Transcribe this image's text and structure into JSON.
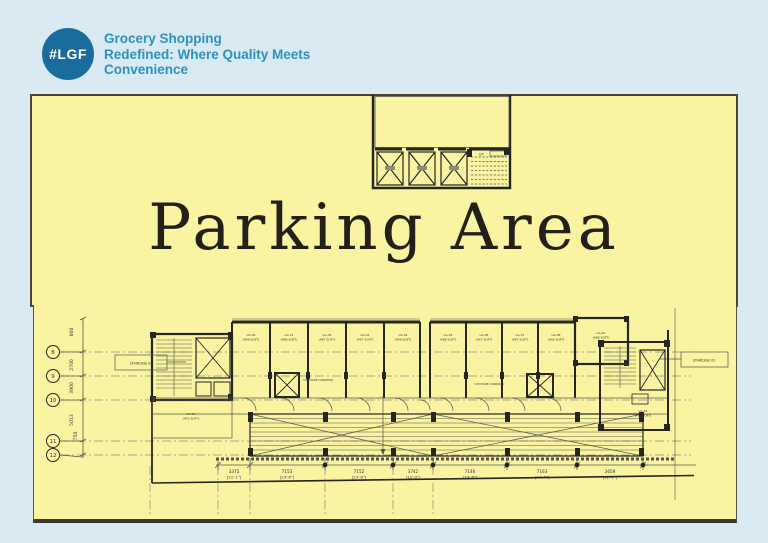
{
  "header": {
    "logo_text": "#LGF",
    "tagline_line1": "Grocery Shopping",
    "tagline_line2": "Redefined: Where Quality Meets",
    "tagline_line3": "Convenience"
  },
  "parking": {
    "title": "Parking Area"
  },
  "upper_core": {
    "up_label": "UP"
  },
  "floor_plan": {
    "grid_bubbles": [
      "8",
      "9",
      "10",
      "11",
      "12"
    ],
    "left_dimensions": [
      "600",
      "2700",
      "3900",
      "5013",
      "750"
    ],
    "bottom_dimensions": [
      {
        "mm": "3375",
        "ft": "[11'-1\"]"
      },
      {
        "mm": "7153",
        "ft": "[23'-6\"]"
      },
      {
        "mm": "7152",
        "ft": "[23'-6\"]"
      },
      {
        "mm": "3742",
        "ft": "[12'-3\"]"
      },
      {
        "mm": "7146",
        "ft": "[23'-6\"]"
      },
      {
        "mm": "7163",
        "ft": "[23'-6\"]"
      },
      {
        "mm": "3659",
        "ft": "[12'-0\"]"
      }
    ],
    "units_bank1": [
      {
        "name": "LG-30",
        "area": "(498 SQFT)"
      },
      {
        "name": "LG-31",
        "area": "(488 SQFT)"
      },
      {
        "name": "LG-32",
        "area": "(487 SQFT)"
      },
      {
        "name": "LG-33",
        "area": "(487 SQFT)"
      },
      {
        "name": "LG-34",
        "area": "(488 SQFT)"
      }
    ],
    "units_bank2": [
      {
        "name": "LG-35",
        "area": "(488 SQFT)"
      },
      {
        "name": "LG-36",
        "area": "(487 SQFT)"
      },
      {
        "name": "LG-37",
        "area": "(487 SQFT)"
      },
      {
        "name": "LG-38",
        "area": "(496 SQFT)"
      },
      {
        "name": "LG-40",
        "area": "(488 SQFT)"
      }
    ],
    "unit_left": {
      "name": "LG-29",
      "area": "(452 SQFT)"
    },
    "unit_right": {
      "name": "LG-43",
      "area": "(736 SQFT)"
    },
    "staircase_left_label": "STAIRCASE 02",
    "staircase_right_label": "STAIRCASE 03",
    "corridor_label": "3.0M WIDE CORRIDOR"
  },
  "colors": {
    "page_background": "#d9eaf2",
    "panel_yellow": "#f9f3a2",
    "logo_blue": "#1a6c9d",
    "tagline_blue": "#2e90c1",
    "plan_line_dark": "#262620",
    "title_black": "#23201a"
  }
}
